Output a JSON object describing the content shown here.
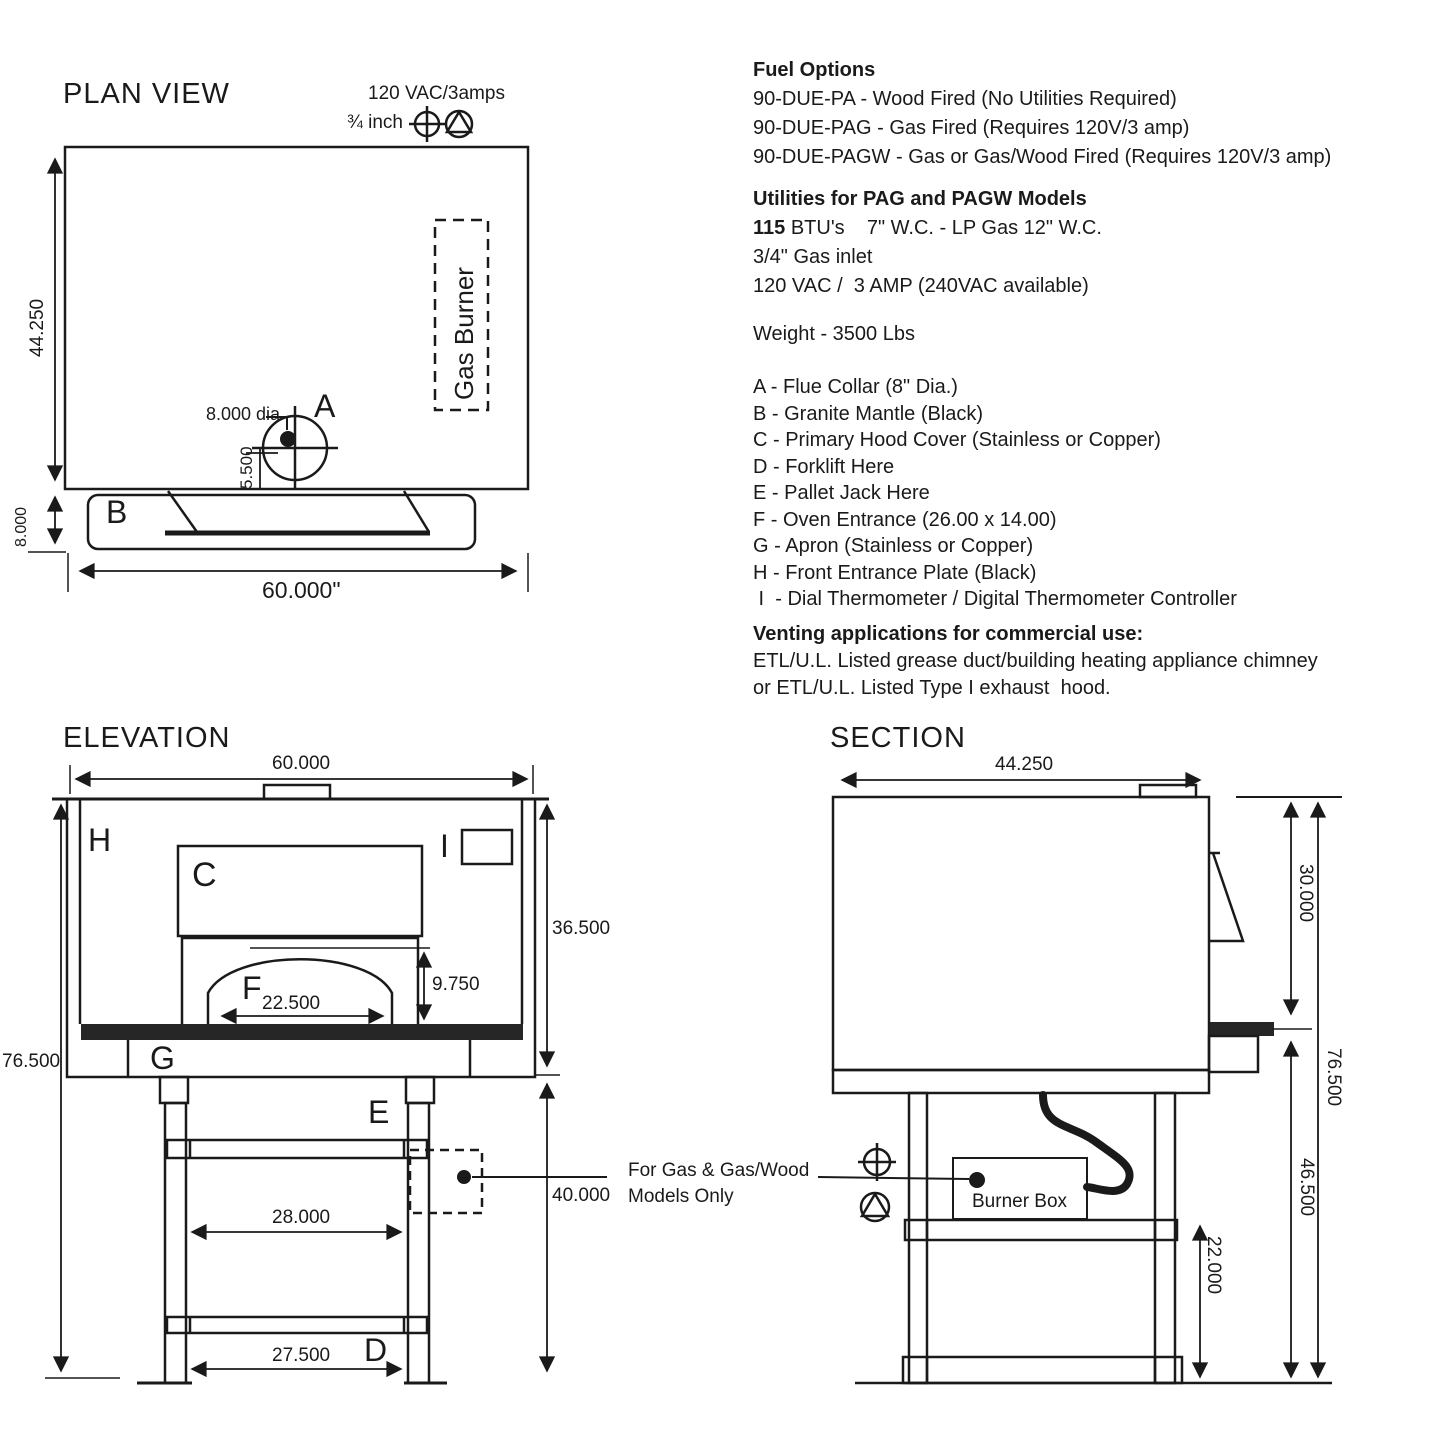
{
  "colors": {
    "line": "#1a1a1a",
    "dark_fill": "#262626",
    "background": "#ffffff"
  },
  "plan": {
    "title": "PLAN VIEW",
    "power_label": "120 VAC/3amps",
    "gas_inlet_size": "¾ inch",
    "gas_burner_label": "Gas Burner",
    "flue_letter": "A",
    "flue_diameter": "8.000 dia",
    "flue_offset_dim": "5.500",
    "mantle_letter": "B",
    "depth_dim": "44.250",
    "mantle_depth_dim": "8.000",
    "width_dim": "60.000\""
  },
  "elevation": {
    "title": "ELEVATION",
    "width_dim": "60.000",
    "front_plate_letter": "H",
    "hood_letter": "C",
    "thermometer_letter": "I",
    "oven_height_dim": "36.500",
    "entrance_letter": "F",
    "entrance_width_dim": "22.500",
    "entrance_height_dim": "9.750",
    "apron_letter": "G",
    "pallet_jack_letter": "E",
    "total_height_dim": "76.500",
    "stand_height_dim": "40.000",
    "stand_inner_width_dim": "28.000",
    "forklift_letter": "D",
    "stand_foot_width_dim": "27.500"
  },
  "note": {
    "line1": "For Gas & Gas/Wood",
    "line2": "Models Only"
  },
  "section": {
    "title": "SECTION",
    "depth_dim": "44.250",
    "dome_height_dim": "30.000",
    "total_height_dim": "76.500",
    "stand_height_dim": "46.500",
    "shelf_height_dim": "22.000",
    "burner_box_label": "Burner Box"
  },
  "specs": {
    "fuel_title": "Fuel Options",
    "fuel_lines": [
      "90-DUE-PA - Wood Fired (No Utilities Required)",
      "90-DUE-PAG - Gas Fired (Requires 120V/3 amp)",
      "90-DUE-PAGW - Gas or Gas/Wood Fired (Requires 120V/3 amp)"
    ],
    "utilities_title": "Utilities for PAG and PAGW Models",
    "btu_bold": "115",
    "btu_rest": " BTU's    7\" W.C. - LP Gas 12\" W.C.",
    "utility_lines": [
      "3/4\" Gas inlet",
      "120 VAC /  3 AMP (240VAC available)"
    ],
    "weight": "Weight - 3500 Lbs",
    "legend": [
      "A - Flue Collar (8\" Dia.)",
      "B - Granite Mantle (Black)",
      "C - Primary Hood Cover (Stainless or Copper)",
      "D - Forklift Here",
      "E - Pallet Jack Here",
      "F - Oven Entrance (26.00 x 14.00)",
      "G - Apron (Stainless or Copper)",
      "H - Front Entrance Plate (Black)",
      " I  - Dial Thermometer / Digital Thermometer Controller"
    ],
    "venting_title": "Venting applications for commercial use:",
    "venting_lines": [
      "ETL/U.L. Listed grease duct/building heating appliance chimney",
      "or ETL/U.L. Listed Type I exhaust  hood."
    ]
  }
}
